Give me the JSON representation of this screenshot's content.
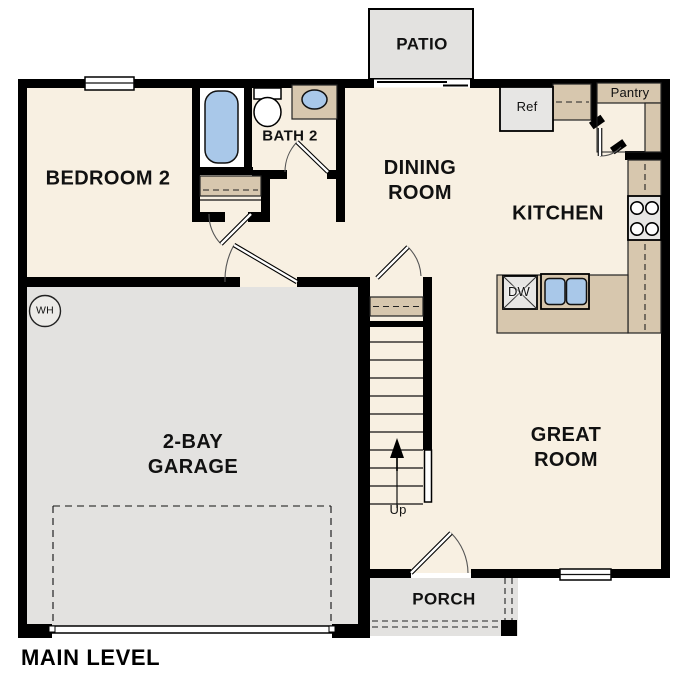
{
  "title": "MAIN LEVEL",
  "colors": {
    "floor": "#f8f0e2",
    "hard": "#e3e2e0",
    "counter": "#d7c7ae",
    "blue": "#a9c8e9",
    "wall": "#000000"
  },
  "rooms": {
    "patio": "PATIO",
    "bedroom2": "BEDROOM 2",
    "bath2": "BATH 2",
    "dining": "DINING ROOM",
    "kitchen": "KITCHEN",
    "great": "GREAT ROOM",
    "garage": "2-BAY GARAGE",
    "porch": "PORCH"
  },
  "fixtures": {
    "pantry": "Pantry",
    "ref": "Ref",
    "dw": "DW",
    "wh": "WH",
    "up": "Up"
  }
}
